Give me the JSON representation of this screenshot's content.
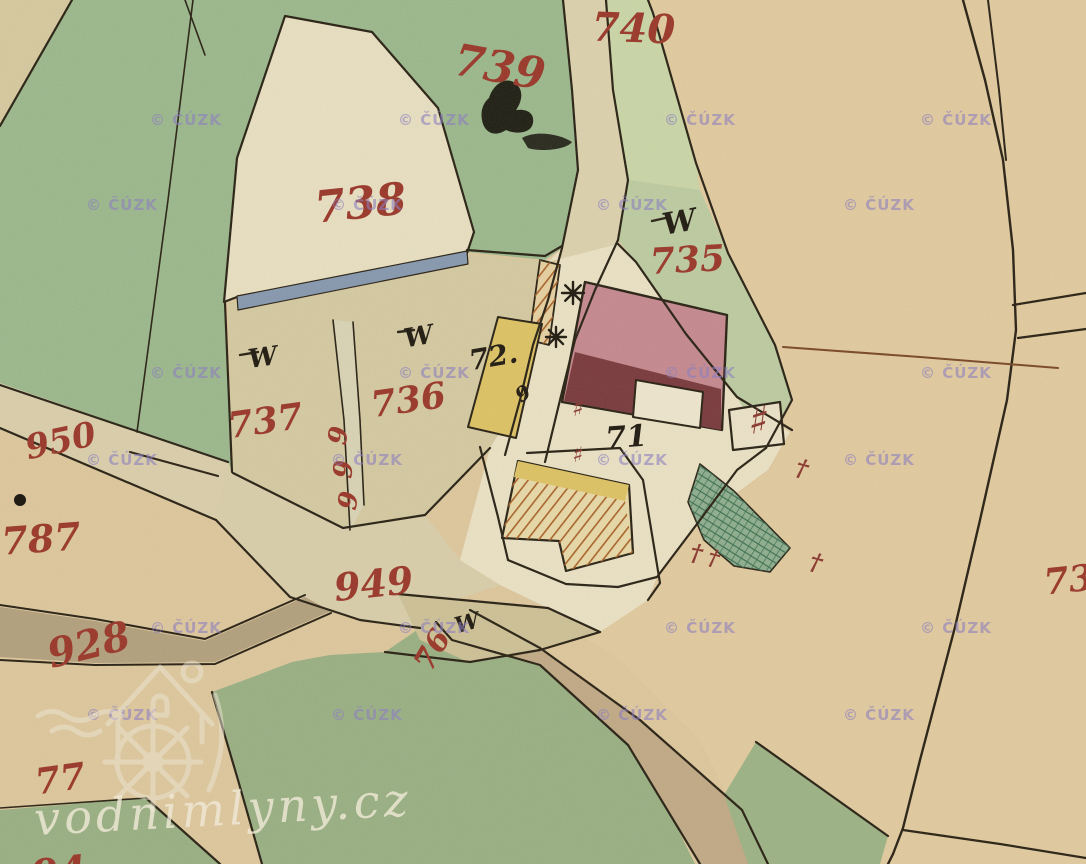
{
  "map": {
    "type": "historical-cadastral-map",
    "palette": {
      "parchment": "#dcc69c",
      "field_tan": "#e0c99e",
      "meadow_green": "#9aaf83",
      "dark_line": "#2b2416",
      "red": "#9a392b",
      "black": "#221c12",
      "mark_red": "#8a3a30",
      "water_blue": "#8798ae",
      "road_brown": "#b2a07d",
      "watermark_purple": "#8d80c0",
      "brand_cream": "#f1ead8"
    },
    "shapes": [
      {
        "name": "region-right-field",
        "pts": "640,0 1086,0 1086,864 760,864 700,740 620,660 540,610 610,580 700,522 770,470 792,430 737,397 686,334 636,262 620,205 606,0",
        "fill": "#e0c99e"
      },
      {
        "name": "region-meadow-topleft",
        "pts": "0,0 563,0 572,100 577,170 562,248 545,260 467,252 237,297 225,303 232,472 218,478 0,385",
        "fill": "#9cb78c"
      },
      {
        "name": "region-corner-triangle",
        "pts": "0,0 72,0 0,126",
        "fill": "#d5c89e"
      },
      {
        "name": "region-road-north",
        "pts": "563,0 606,0 613,90 628,180 618,240 595,290 575,340 560,400 545,462 505,455 520,400 533,345 548,300 562,248 578,170 572,90",
        "fill": "#dbd0ac"
      },
      {
        "name": "region-parcels-736-737",
        "pts": "228,303 467,254 548,262 533,345 505,455 490,448 425,515 343,528 233,473",
        "fill": "#d3c8a0"
      },
      {
        "name": "region-road-junction",
        "pts": "0,385 228,462 233,473 343,528 425,515 460,560 500,585 455,600 420,628 360,620 290,597 216,520 0,430",
        "fill": "#d8cda9"
      },
      {
        "name": "region-mill-courtyard",
        "pts": "548,262 618,244 636,262 686,334 737,397 790,432 768,470 700,520 657,577 648,600 600,632 548,608 500,585 460,560 490,448 520,400 533,345 548,300 562,248",
        "fill": "#e9e0c3"
      },
      {
        "name": "region-strip-740",
        "pts": "572,0 648,0 653,13 696,163 700,190 628,180 613,90 606,0",
        "fill": "#c9d4a6"
      },
      {
        "name": "region-parcel-735-green",
        "pts": "628,180 700,190 728,253 775,345 792,400 766,448 737,397 686,334 636,262 618,240",
        "fill": "#bccaa0"
      },
      {
        "name": "region-parcel-738",
        "pts": "285,16 372,32 438,108 474,232 467,253 237,297 224,302 237,158",
        "fill": "#e7dec0",
        "stroke": "#2b2416",
        "w": 2.2
      },
      {
        "name": "region-road-west",
        "pts": "0,383 228,462 216,520 0,428",
        "fill": "#d9cdaa"
      },
      {
        "name": "region-road-928",
        "pts": "0,607 95,621 205,641 305,597 331,611 215,662 95,663 0,657",
        "fill": "#b2a07d"
      },
      {
        "name": "region-meadow-bottom",
        "pts": "212,692 262,864 695,864 638,748 558,672 488,626 448,612 420,628 385,652 330,655 292,662 250,678",
        "fill": "#9aaf83"
      },
      {
        "name": "region-road-southeast",
        "pts": "436,622 470,610 540,648 640,720 742,810 768,864 700,864 628,745 540,665 452,640",
        "fill": "#c0a985"
      },
      {
        "name": "region-meadow-se-patch",
        "pts": "756,742 888,836 880,864 748,864 724,795",
        "fill": "#9db285"
      },
      {
        "name": "region-meadow-bl-corner",
        "pts": "0,810 146,798 220,864 0,864",
        "fill": "#9aaf83"
      },
      {
        "name": "region-parcel-76",
        "pts": "398,594 548,608 600,632 540,650 468,662 420,640",
        "fill": "#cdc096"
      },
      {
        "name": "region-mill-race",
        "pts": "333,320 353,322 364,505 350,530 344,420",
        "fill": "#d8d2b4"
      },
      {
        "name": "region-stream-blue",
        "pts": "237,296 467,251 468,264 238,310",
        "fill": "#8798ae",
        "stroke": "#2b2416",
        "w": 1.2
      },
      {
        "name": "building-hatched-nw",
        "pts": "540,260 560,265 549,345 529,340",
        "fill": "#e4cf9f",
        "hatch": "hatchO",
        "stroke": "#2b2416",
        "w": 1.8
      },
      {
        "name": "building-yellow-west",
        "pts": "498,317 542,324 516,438 468,427",
        "fill": "#dcc164",
        "stroke": "#2b2416",
        "w": 2
      },
      {
        "name": "building-mill-pink",
        "pts": "585,282 727,315 722,430 562,402",
        "fill": "#c4898e",
        "stroke": "#2b2416",
        "w": 2.4
      },
      {
        "name": "building-mill-dark-wing",
        "pts": "575,352 721,389 721,430 564,401",
        "fill": "#7a3b3e"
      },
      {
        "name": "building-mill-notch",
        "pts": "636,380 703,392 700,428 633,417",
        "fill": "#ece4cb",
        "stroke": "#2b2416",
        "w": 2
      },
      {
        "name": "building-small-east",
        "pts": "729,410 780,402 784,444 733,450",
        "fill": "#e9e0c6",
        "stroke": "#2b2416",
        "w": 2.2
      },
      {
        "name": "building-barn",
        "pts": "518,461 629,485 633,553 566,571 559,541 502,538",
        "fill": "#e6d7a6",
        "stroke": "#2b2416",
        "w": 2.2
      },
      {
        "name": "building-barn-yellow-strip",
        "pts": "518,461 629,485 625,501 514,477",
        "fill": "#dcc164"
      },
      {
        "name": "building-barn-hatched",
        "pts": "514,477 625,501 633,553 566,571 559,541 502,538",
        "fill": "none",
        "hatch": "hatchO"
      },
      {
        "name": "garden-hatched-green",
        "pts": "700,464 734,491 790,548 770,572 734,566 704,540 688,502",
        "fill": "#8fae8e",
        "hatch": "hatchG",
        "stroke": "#2b2416",
        "w": 1.6
      }
    ],
    "lines": [
      {
        "name": "boundary-green-inner",
        "pts": "193,0 168,200 137,432",
        "w": 1.6
      },
      {
        "name": "boundary-corner",
        "pts": "72,0 0,126"
      },
      {
        "name": "boundary-top-small",
        "pts": "185,0 205,55",
        "w": 1.6
      },
      {
        "name": "road-north-west-edge",
        "pts": "563,0 572,90 578,170 562,248 548,300 533,345 520,400 505,455"
      },
      {
        "name": "road-north-east-edge",
        "pts": "606,0 613,90 628,180 618,240 595,290 575,340 560,400 545,462"
      },
      {
        "name": "boundary-field-ne",
        "pts": "648,0 653,13 696,163 728,253 775,345 792,400 766,448"
      },
      {
        "name": "boundary-72-north",
        "pts": "467,250 545,256 562,246"
      },
      {
        "name": "boundary-courtyard-east",
        "pts": "618,244 636,262 686,334 737,397 792,430"
      },
      {
        "name": "boundary-courtyard-se",
        "pts": "766,448 737,470 700,520 657,577 618,587 566,584 508,560"
      },
      {
        "name": "road-east-main",
        "pts": "963,0 985,80 1003,160 1013,250 1016,330 1007,400 980,520 955,627 920,760 903,828 893,854 888,864",
        "w": 2.4
      },
      {
        "name": "road-east-second",
        "pts": "988,0 999,90 1006,160",
        "w": 2
      },
      {
        "name": "road-east-branch-a",
        "pts": "1013,305 1086,293"
      },
      {
        "name": "road-east-branch-b",
        "pts": "1018,338 1086,329"
      },
      {
        "name": "road-corner-branch",
        "pts": "903,830 1000,844 1086,858"
      },
      {
        "name": "boundary-brown-thin",
        "pts": "783,347 920,357 1058,368",
        "color": "#7a4a28",
        "w": 2
      },
      {
        "name": "mill-race-west-edge",
        "pts": "333,320 344,420 350,530",
        "w": 1.6
      },
      {
        "name": "mill-race-east-edge",
        "pts": "353,322 360,420 364,505",
        "w": 1.6
      },
      {
        "name": "boundary-737-south",
        "pts": "233,473 343,528 425,515 490,448"
      },
      {
        "name": "junction-north",
        "pts": "130,452 218,476"
      },
      {
        "name": "road-west-south-edge",
        "pts": "0,428 216,520"
      },
      {
        "name": "road-west-north-edge",
        "pts": "0,385 228,462"
      },
      {
        "name": "junction-south-edge",
        "pts": "216,520 290,597 360,620 420,628"
      },
      {
        "name": "boundary-barn-court",
        "pts": "527,453 620,448 643,480 660,583 648,600"
      },
      {
        "name": "road-edge-barn-west",
        "pts": "480,447 498,517 508,560"
      },
      {
        "name": "boundary-76-north",
        "pts": "398,594 548,608 600,632"
      },
      {
        "name": "boundary-76-south",
        "pts": "385,652 470,662 540,650 600,632"
      },
      {
        "name": "road-se-lower-edge",
        "pts": "436,622 452,640 540,665 628,745 700,864"
      },
      {
        "name": "road-se-upper-edge",
        "pts": "470,610 540,648 640,720 742,810 768,864"
      },
      {
        "name": "meadow-west-boundary",
        "pts": "212,692 238,780 262,864"
      },
      {
        "name": "meadow-bl-boundary",
        "pts": "146,798 220,864"
      },
      {
        "name": "meadow-bl-top",
        "pts": "0,808 146,798",
        "w": 1.6
      },
      {
        "name": "meadow-se-boundary",
        "pts": "756,742 888,836"
      },
      {
        "name": "boundary-737-west",
        "pts": "225,303 232,472"
      },
      {
        "name": "road-928-north-edge",
        "pts": "0,605 95,619 205,639 305,595",
        "w": 2
      },
      {
        "name": "road-928-south-edge",
        "pts": "0,660 95,665 215,664 331,613",
        "w": 2
      },
      {
        "name": "w-dash-735",
        "pts": "652,221 670,217",
        "w": 2.4
      },
      {
        "name": "w-dash-736",
        "pts": "398,332 414,330",
        "w": 2.4
      },
      {
        "name": "w-dash-737",
        "pts": "240,355 258,352",
        "w": 2.4
      }
    ],
    "parcel_labels": [
      {
        "text": "740",
        "x": 633,
        "y": 42,
        "rot": 2,
        "size": 40,
        "c": "red"
      },
      {
        "text": "739",
        "x": 497,
        "y": 82,
        "rot": 10,
        "size": 44,
        "c": "red"
      },
      {
        "text": "738",
        "x": 362,
        "y": 218,
        "rot": -6,
        "size": 44,
        "c": "red"
      },
      {
        "text": "735",
        "x": 688,
        "y": 272,
        "rot": -3,
        "size": 36,
        "c": "red"
      },
      {
        "text": "736",
        "x": 410,
        "y": 412,
        "rot": -8,
        "size": 36,
        "c": "red"
      },
      {
        "text": "737",
        "x": 267,
        "y": 433,
        "rot": -8,
        "size": 36,
        "c": "red"
      },
      {
        "text": "950",
        "x": 63,
        "y": 452,
        "rot": -12,
        "size": 34,
        "c": "red"
      },
      {
        "text": "787",
        "x": 42,
        "y": 552,
        "rot": -4,
        "size": 38,
        "c": "red"
      },
      {
        "text": "928",
        "x": 92,
        "y": 658,
        "rot": -14,
        "size": 40,
        "c": "red"
      },
      {
        "text": "949",
        "x": 375,
        "y": 597,
        "rot": -6,
        "size": 38,
        "c": "red"
      },
      {
        "text": "77",
        "x": 62,
        "y": 791,
        "rot": -8,
        "size": 36,
        "c": "red"
      },
      {
        "text": "76",
        "x": 441,
        "y": 655,
        "rot": -60,
        "size": 30,
        "c": "red"
      },
      {
        "text": "73",
        "x": 1070,
        "y": 592,
        "rot": -6,
        "size": 36,
        "c": "red"
      },
      {
        "text": "94",
        "x": 60,
        "y": 886,
        "rot": -6,
        "size": 40,
        "c": "red"
      },
      {
        "text": "9",
        "x": 347,
        "y": 437,
        "rot": -80,
        "size": 26,
        "c": "red"
      },
      {
        "text": "9",
        "x": 352,
        "y": 470,
        "rot": -85,
        "size": 26,
        "c": "red"
      },
      {
        "text": "9",
        "x": 357,
        "y": 502,
        "rot": -80,
        "size": 26,
        "c": "red"
      },
      {
        "text": "W",
        "x": 681,
        "y": 232,
        "rot": -10,
        "size": 30,
        "c": "black"
      },
      {
        "text": "W",
        "x": 420,
        "y": 345,
        "rot": -10,
        "size": 26,
        "c": "black"
      },
      {
        "text": "W",
        "x": 264,
        "y": 366,
        "rot": -8,
        "size": 26,
        "c": "black"
      },
      {
        "text": "W",
        "x": 469,
        "y": 630,
        "rot": -15,
        "size": 22,
        "c": "black"
      },
      {
        "text": "72.",
        "x": 495,
        "y": 366,
        "rot": -10,
        "size": 28,
        "c": "black"
      },
      {
        "text": "71",
        "x": 627,
        "y": 447,
        "rot": -4,
        "size": 30,
        "c": "black"
      },
      {
        "text": "9",
        "x": 527,
        "y": 399,
        "rot": -35,
        "size": 20,
        "c": "black"
      }
    ],
    "marks": [
      {
        "type": "star",
        "name": "waterwheel-symbol",
        "x": 573,
        "y": 293,
        "s": 11
      },
      {
        "type": "star",
        "name": "waterwheel-symbol",
        "x": 556,
        "y": 337,
        "s": 10
      },
      {
        "type": "hash",
        "name": "red-hash-mark",
        "x": 757,
        "y": 434,
        "rot": 8,
        "size": 40
      },
      {
        "type": "hash",
        "name": "red-hash-mark",
        "x": 577,
        "y": 416,
        "rot": 8,
        "size": 24
      },
      {
        "type": "hash",
        "name": "red-hash-mark",
        "x": 577,
        "y": 462,
        "rot": 8,
        "size": 22
      },
      {
        "type": "dagger",
        "name": "red-cross-mark",
        "x": 695,
        "y": 561,
        "rot": 10,
        "size": 24
      },
      {
        "type": "dagger",
        "name": "red-cross-mark",
        "x": 712,
        "y": 565,
        "rot": 14,
        "size": 22
      },
      {
        "type": "dagger",
        "name": "red-cross-mark",
        "x": 800,
        "y": 476,
        "rot": 15,
        "size": 24
      },
      {
        "type": "dagger",
        "name": "red-cross-mark",
        "x": 814,
        "y": 570,
        "rot": 15,
        "size": 24
      },
      {
        "type": "dot",
        "name": "ink-dot",
        "x": 20,
        "y": 500,
        "r": 6
      }
    ],
    "ink_blots": [
      {
        "name": "ink-blot-739",
        "path": "M489,98 C494,82 508,76 516,84 C524,90 522,102 516,110 C530,108 536,116 532,126 C528,134 514,134 506,130 C494,138 484,132 482,120 C480,110 484,102 489,98 Z",
        "opacity": 0.92
      },
      {
        "name": "ink-smear-739",
        "path": "M522,138 C536,130 560,134 572,142 C566,150 540,152 528,148 Z",
        "opacity": 0.85
      }
    ],
    "copyright_watermark": {
      "text": "© ČÚZK",
      "size": 15,
      "opacity": 0.6,
      "rows_a": [
        125,
        378,
        633
      ],
      "cols_a": [
        150,
        398,
        664,
        920
      ],
      "rows_b": [
        210,
        465,
        720
      ],
      "cols_b": [
        86,
        331,
        596,
        843
      ]
    },
    "brand": {
      "text": "vodnimlyny.cz",
      "x": 35,
      "y": 835,
      "size": 46,
      "rot": -3,
      "opacity": 0.8
    }
  }
}
